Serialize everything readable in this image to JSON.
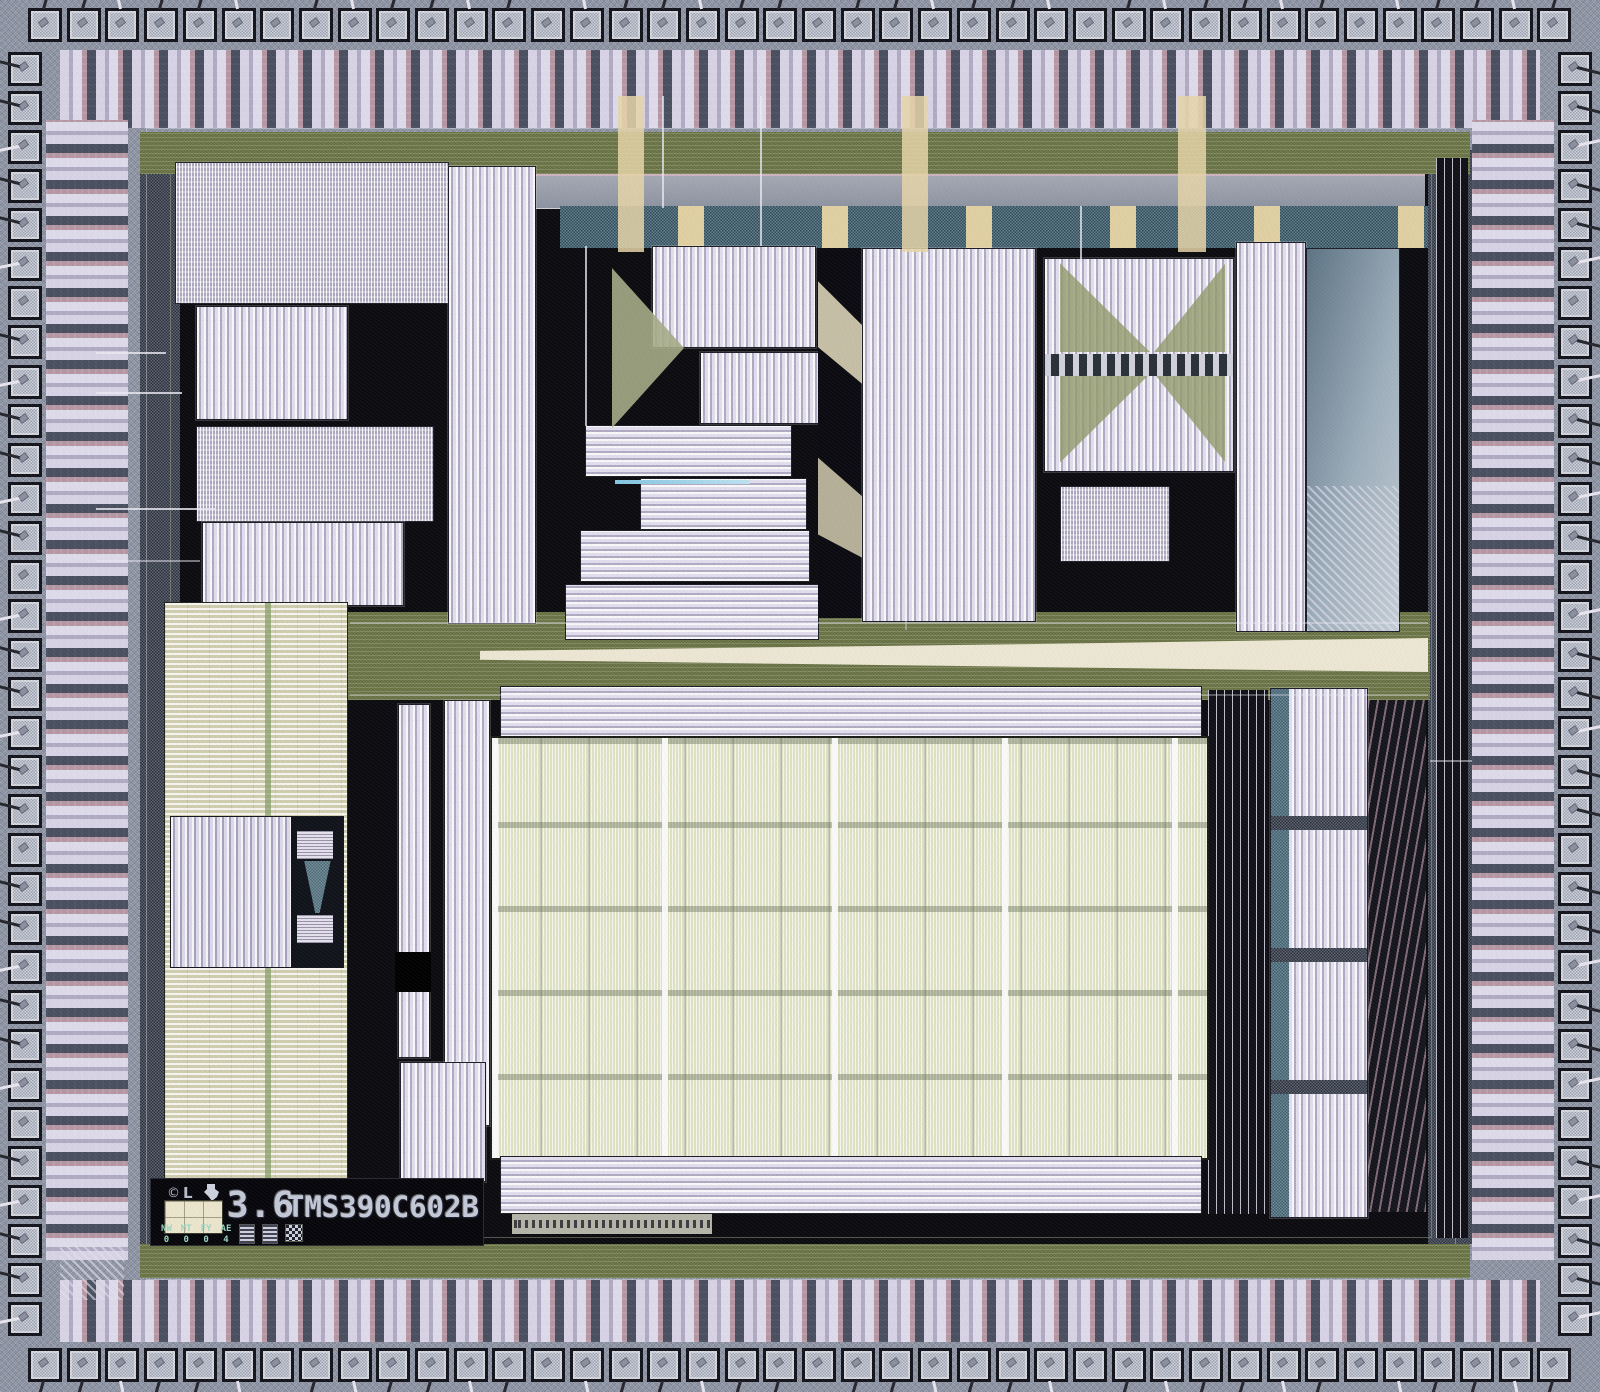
{
  "die_markings": {
    "copyright_mark": "©",
    "logo_mark": "L",
    "scale_mark": "3.6",
    "part_number": "TMS390C602B",
    "revision_codes": [
      {
        "label": "NW",
        "value": "0"
      },
      {
        "label": "MT",
        "value": "0"
      },
      {
        "label": "FY",
        "value": "0"
      },
      {
        "label": "AE",
        "value": "4"
      }
    ]
  },
  "palette": {
    "frame_speckle": "#8d95a4",
    "bond_pad": "#bcc2cf",
    "die_background": "#0b0b10",
    "olive_ring": "#76804e",
    "cream_bus": "#f0ead6",
    "cell_lavender": "#d9d4e6",
    "array_cream": "#ebe8d0",
    "array_sage": "#e3e5c6",
    "teal_band": "#3f6172",
    "steel_panel": "#9fb0bd",
    "marking_text": "#c6ccda"
  }
}
